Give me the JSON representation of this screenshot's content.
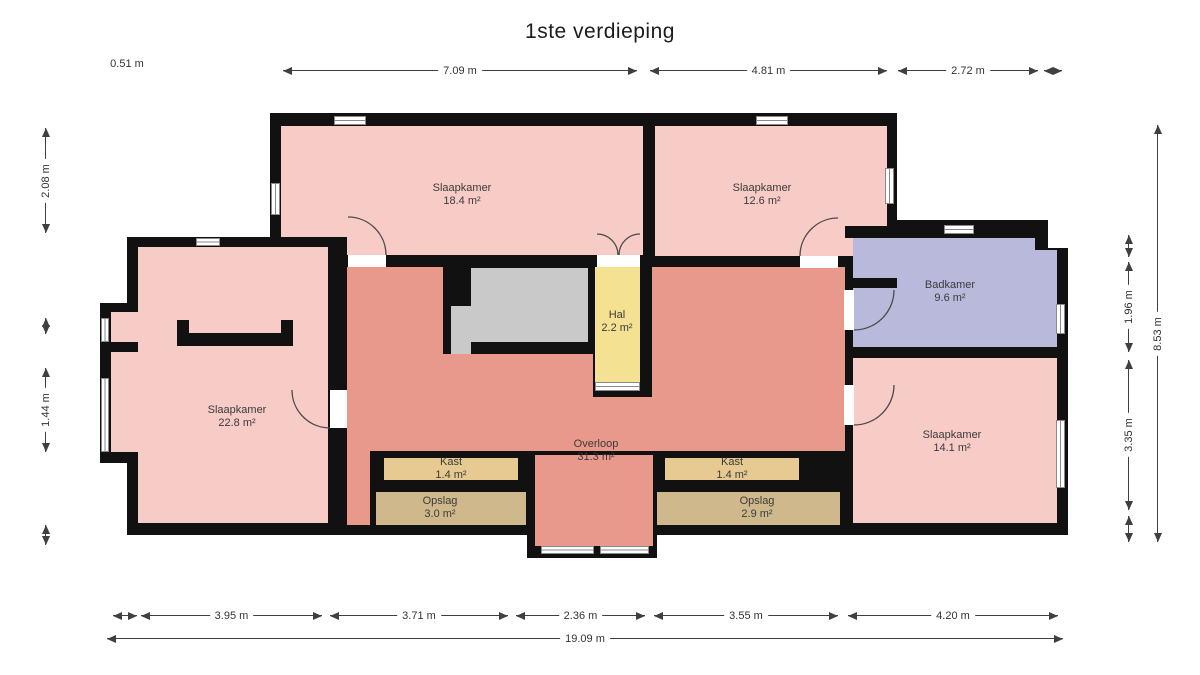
{
  "title": "1ste verdieping",
  "rooms": [
    {
      "id": "slaapkamer-18",
      "name": "Slaapkamer",
      "area": "18.4 m²"
    },
    {
      "id": "slaapkamer-12",
      "name": "Slaapkamer",
      "area": "12.6 m²"
    },
    {
      "id": "badkamer",
      "name": "Badkamer",
      "area": "9.6 m²"
    },
    {
      "id": "slaapkamer-22",
      "name": "Slaapkamer",
      "area": "22.8 m²"
    },
    {
      "id": "hal",
      "name": "Hal",
      "area": "2.2 m²"
    },
    {
      "id": "overloop",
      "name": "Overloop",
      "area": "31.3 m²"
    },
    {
      "id": "kast-links",
      "name": "Kast",
      "area": "1.4 m²"
    },
    {
      "id": "opslag-links",
      "name": "Opslag",
      "area": "3.0 m²"
    },
    {
      "id": "kast-rechts",
      "name": "Kast",
      "area": "1.4 m²"
    },
    {
      "id": "opslag-rechts",
      "name": "Opslag",
      "area": "2.9 m²"
    },
    {
      "id": "slaapkamer-14",
      "name": "Slaapkamer",
      "area": "14.1 m²"
    }
  ],
  "dimensions": {
    "top": [
      "0.51 m",
      "7.09 m",
      "4.81 m",
      "2.72 m"
    ],
    "left": [
      "2.08 m",
      "1.44 m"
    ],
    "right": [
      "1.96 m",
      "3.35 m",
      "8.53 m"
    ],
    "bottom": [
      "3.95 m",
      "3.71 m",
      "2.36 m",
      "3.55 m",
      "4.20 m"
    ],
    "total_width": "19.09 m"
  },
  "colors": {
    "bedroom": "#f7cbc6",
    "landing": "#e8998b",
    "hal": "#f5e192",
    "bathroom": "#b9badb",
    "stairs": "#c9c9c9",
    "closet": "#e6ca92",
    "storage": "#cfb98c",
    "wall": "#111111"
  }
}
